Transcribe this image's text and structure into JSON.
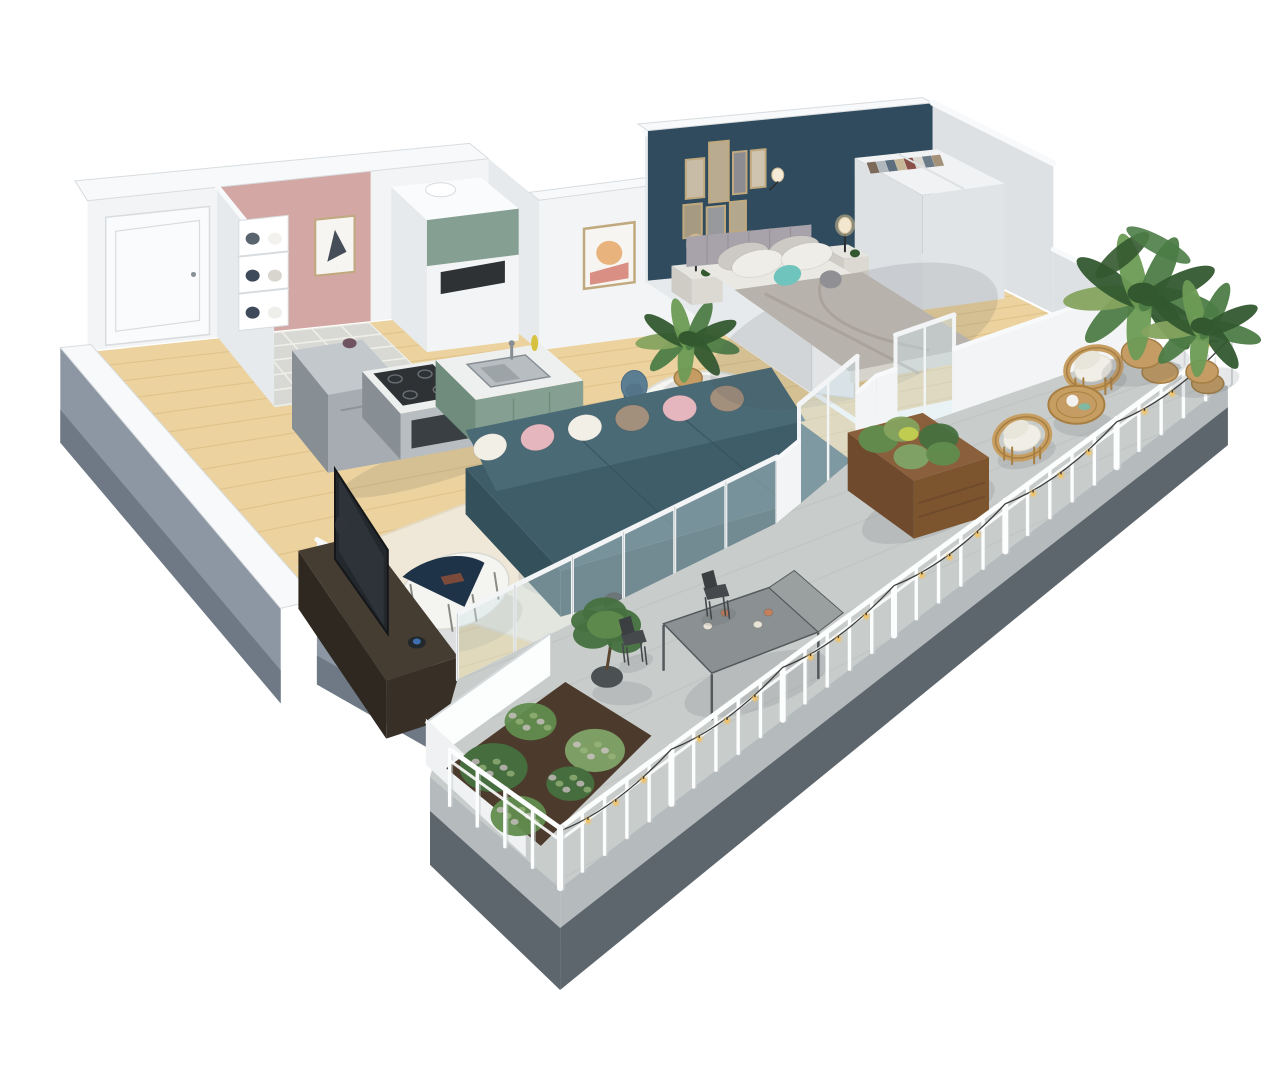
{
  "scene": {
    "kind": "3d-isometric-floor-plan-render",
    "description": "Cutaway 3D floor plan of a one-bedroom apartment with an L-shaped concrete balcony, white picket railing and string lights",
    "rooms": [
      {
        "id": "entrance-hall",
        "label": "Entrance hall",
        "floor": "light wood"
      },
      {
        "id": "bathroom",
        "label": "Bathroom",
        "floor": "grey tile",
        "accent_wall": "dusty pink"
      },
      {
        "id": "kitchen",
        "label": "Kitchen",
        "floor": "light wood",
        "cabinets": "sage green"
      },
      {
        "id": "dining-area",
        "label": "Dining area",
        "floor": "light wood"
      },
      {
        "id": "living-room",
        "label": "Living room",
        "floor": "light wood with cream rug"
      },
      {
        "id": "bedroom",
        "label": "Bedroom",
        "floor": "light wood",
        "accent_wall": "dark teal"
      },
      {
        "id": "balcony",
        "label": "Wrap-around balcony",
        "floor": "concrete"
      }
    ],
    "furniture": {
      "entrance-hall": [
        "entrance door"
      ],
      "bathroom": [
        "towel shelf",
        "framed geometric art"
      ],
      "kitchen": [
        "tall cabinet with microwave",
        "green upper cabinet",
        "fridge",
        "oven with cooktop",
        "green base cabinets",
        "double sink"
      ],
      "dining-area": [
        "round marble table",
        "4 blue shell chairs",
        "table settings",
        "potted palm",
        "framed abstract art"
      ],
      "living-room": [
        "teal fabric sofa",
        "6 cushions",
        "two-tone oval coffee table",
        "black floor lamp",
        "taupe pouf",
        "cream rug",
        "dark media console with TV"
      ],
      "bedroom": [
        "double bed with grey duvet",
        "grey tufted headboard",
        "teal accent cushion",
        "2 nightstands with lamps",
        "gallery of 7 frames",
        "open wardrobe with clothes"
      ],
      "balcony": [
        "white picket fence",
        "string lights",
        "2 rattan armchairs",
        "rattan side table",
        "wooden raised planter",
        "potted palms",
        "metal bistro table with candles",
        "2 metal chairs",
        "planter bed with shrubs"
      ]
    }
  },
  "palette": {
    "bg": "#ffffff",
    "wallWhite": "#f3f4f5",
    "wallBright": "#fafbfc",
    "wallShade": "#e7eaec",
    "wallShade2": "#dde1e4",
    "ribbon": "#f8f9fa",
    "ribbonEdge": "#d8dcdf",
    "outerGray": "#8d97a3",
    "outerGrayDark": "#6e7985",
    "slabLight": "#b5bbbd",
    "slabDark": "#5e666d",
    "pinkWall": "#d3a7a3",
    "blueWall": "#304b5e",
    "wood": "#ebd29e",
    "woodLine": "#d8b77d",
    "tile": "#d8d9d4",
    "tileLine": "#efefe9",
    "concrete": "#c8cccb",
    "concreteLine": "#b9bfbe",
    "fenceWhite": "#fcfdfd",
    "fenceShade": "#d5dadd",
    "wire": "#3c3c3c",
    "bulb": "#f0c36a",
    "glass": "#cfe3e8",
    "glassFrame": "#f2f4f5",
    "sofa": "#3f5d68",
    "sofaDark": "#34505a",
    "sofaLight": "#4a6a76",
    "pillowPink": "#e5b6bd",
    "pillowWhite": "#f2efe7",
    "pillowTaupe": "#a28f7c",
    "rug": "#efe8d8",
    "rugEdge": "#e4dac4",
    "coffeeNavy": "#1e3347",
    "coffeeWhite": "#f4f4f1",
    "black": "#2a2d30",
    "pouf": "#b0a08c",
    "tvWood": "#453c32",
    "tvScreen": "#23282d",
    "counter": "#eef0ef",
    "green": "#85a092",
    "greenDark": "#6f8c7d",
    "steel": "#b7bdc0",
    "steelDark": "#878f94",
    "fridge": "#a6acb1",
    "fridgeTop": "#c3c8cc",
    "cooktop": "#2e3235",
    "bottle": "#d6c23e",
    "bedSheet": "#eae8e3",
    "duvet": "#b7b2ab",
    "duvetShade": "#a29c95",
    "bedPillowA": "#cdcac5",
    "bedPillowB": "#efede8",
    "headboard": "#a8a3aa",
    "teal": "#6fc4be",
    "knit": "#8f8f94",
    "stand": "#e7e5e0",
    "lampGlow": "#f6d79c",
    "closet": "#f1f2f3",
    "closetShade": "#e1e4e6",
    "frame": "#c0a97e",
    "artDark": "#454e58",
    "artPeach": "#e8b37c",
    "artPink": "#d98f84",
    "chairBlue": "#5c7e93",
    "chairBlueDark": "#4b6b80",
    "marble": "#f5f5f2",
    "marbleShade": "#dedfd9",
    "plate": "#fbfbf9",
    "plateRim": "#9aa2a8",
    "palm": "#4d7c46",
    "palmDark": "#33582f",
    "palmLight": "#6d9b55",
    "olive": "#85a35f",
    "basket": "#c59c63",
    "basketDark": "#a37e45",
    "rattan": "#c79e62",
    "rattanDark": "#a87f42",
    "cushion": "#f0eee6",
    "plankWood": "#8a5f3b",
    "plankDark": "#6f4a2c",
    "soil": "#4c3b2c",
    "bush": "#46703f",
    "bushLight": "#618c4e",
    "bushPale": "#7fa468",
    "metal": "#8b9192",
    "metalDark": "#55595c",
    "chairMetal": "#46494b",
    "copper": "#c3805c",
    "cream": "#e9e3d6",
    "pot": "#4b5053",
    "shadow": "rgba(70,75,85,0.13)"
  }
}
